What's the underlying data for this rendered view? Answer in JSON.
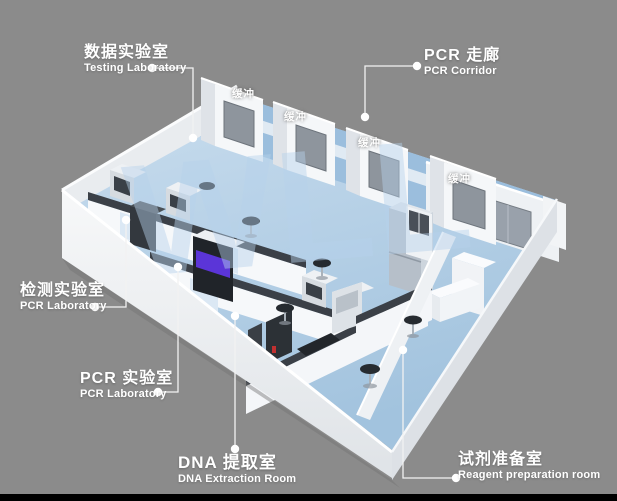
{
  "scene": {
    "background": "#8b8b8b",
    "bottom_bar": "#000000",
    "watermark": "WLL",
    "colors": {
      "floor_blue": "#aecbe4",
      "corridor_blue": "#9bbedd",
      "wall_white": "#f2f4f6",
      "wall_shade": "#dde1e6",
      "bench_top_grey": "#3b4047",
      "window_grey": "#99a1ab",
      "accent_purple": "#5b35d8",
      "stool_black": "#262b30",
      "watermark_blue": "#b7d2ec",
      "label_white": "#ffffff"
    }
  },
  "callouts": {
    "testing_lab": {
      "zh": "数据实验室",
      "en": "Testing Laboratory"
    },
    "pcr_corridor": {
      "zh": "PCR 走廊",
      "en": "PCR Corridor"
    },
    "inspection_lab": {
      "zh": "检测实验室",
      "en": "PCR Laboratory"
    },
    "pcr_lab": {
      "zh": "PCR 实验室",
      "en": "PCR Laboratory"
    },
    "dna_extraction": {
      "zh": "DNA 提取室",
      "en": "DNA Extraction Room"
    },
    "reagent_prep": {
      "zh": "试剂准备室",
      "en": "Reagent preparation room"
    }
  },
  "wall_labels": {
    "buffer": "缓冲"
  }
}
